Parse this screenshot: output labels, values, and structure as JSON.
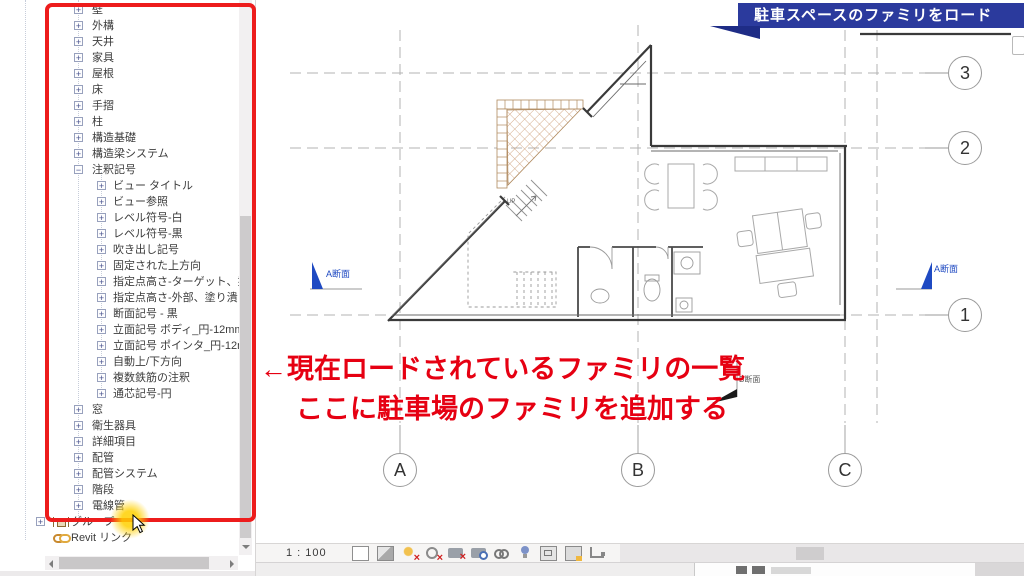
{
  "colors": {
    "highlight_red": "#ed1c1c",
    "banner_blue": "#2b3a9d",
    "annotation_red": "#e60012",
    "section_blue": "#1f4ac2"
  },
  "banner": {
    "label": "駐車スペースのファミリをロード"
  },
  "annotation": {
    "line1": "←現在ロードされているファミリの一覧",
    "line2": "ここに駐車場のファミリを追加する"
  },
  "tree": {
    "items": [
      {
        "label": "壁",
        "level": 1,
        "toggle": "plus"
      },
      {
        "label": "外構",
        "level": 1,
        "toggle": "plus"
      },
      {
        "label": "天井",
        "level": 1,
        "toggle": "plus"
      },
      {
        "label": "家具",
        "level": 1,
        "toggle": "plus"
      },
      {
        "label": "屋根",
        "level": 1,
        "toggle": "plus"
      },
      {
        "label": "床",
        "level": 1,
        "toggle": "plus"
      },
      {
        "label": "手摺",
        "level": 1,
        "toggle": "plus"
      },
      {
        "label": "柱",
        "level": 1,
        "toggle": "plus"
      },
      {
        "label": "構造基礎",
        "level": 1,
        "toggle": "plus"
      },
      {
        "label": "構造梁システム",
        "level": 1,
        "toggle": "plus"
      },
      {
        "label": "注釈記号",
        "level": 1,
        "toggle": "minus"
      },
      {
        "label": "ビュー タイトル",
        "level": 2,
        "toggle": "plus"
      },
      {
        "label": "ビュー参照",
        "level": 2,
        "toggle": "plus"
      },
      {
        "label": "レベル符号-白",
        "level": 2,
        "toggle": "plus"
      },
      {
        "label": "レベル符号-黒",
        "level": 2,
        "toggle": "plus"
      },
      {
        "label": "吹き出し記号",
        "level": 2,
        "toggle": "plus"
      },
      {
        "label": "固定された上方向",
        "level": 2,
        "toggle": "plus"
      },
      {
        "label": "指定点高さ-ターゲット、塗り潰し",
        "level": 2,
        "toggle": "plus"
      },
      {
        "label": "指定点高さ-外部、塗り潰し",
        "level": 2,
        "toggle": "plus"
      },
      {
        "label": "断面記号 - 黒",
        "level": 2,
        "toggle": "plus"
      },
      {
        "label": "立面記号 ボディ_円-12mm",
        "level": 2,
        "toggle": "plus"
      },
      {
        "label": "立面記号 ポインタ_円-12mm",
        "level": 2,
        "toggle": "plus"
      },
      {
        "label": "自動上/下方向",
        "level": 2,
        "toggle": "plus"
      },
      {
        "label": "複数鉄筋の注釈",
        "level": 2,
        "toggle": "plus"
      },
      {
        "label": "通芯記号-円",
        "level": 2,
        "toggle": "plus"
      },
      {
        "label": "窓",
        "level": 1,
        "toggle": "plus"
      },
      {
        "label": "衛生器具",
        "level": 1,
        "toggle": "plus"
      },
      {
        "label": "詳細項目",
        "level": 1,
        "toggle": "plus"
      },
      {
        "label": "配管",
        "level": 1,
        "toggle": "plus"
      },
      {
        "label": "配管システム",
        "level": 1,
        "toggle": "plus"
      },
      {
        "label": "階段",
        "level": 1,
        "toggle": "plus"
      },
      {
        "label": "電線管",
        "level": 1,
        "toggle": "plus"
      },
      {
        "label": "グループ",
        "level": 0,
        "toggle": "plus",
        "icon": "group-icon"
      },
      {
        "label": "Revit リンク",
        "level": 0,
        "toggle": "none",
        "icon": "revit-link-icon"
      }
    ]
  },
  "plan": {
    "grid_right": [
      {
        "label": "3"
      },
      {
        "label": "2"
      },
      {
        "label": "1"
      }
    ],
    "grid_bottom": [
      {
        "label": "A"
      },
      {
        "label": "B"
      },
      {
        "label": "C"
      }
    ],
    "section_left_label": "A断面",
    "section_right_label": "A断面",
    "section_bottom_label": "B断面",
    "stairs_up_label": "UP"
  },
  "view_control_bar": {
    "scale_label": "1 : 100",
    "collapse_label": "<",
    "icons": [
      {
        "name": "detail-level-icon"
      },
      {
        "name": "visual-style-icon"
      },
      {
        "name": "sun-path-icon"
      },
      {
        "name": "shadows-icon"
      },
      {
        "name": "crop-view-icon"
      },
      {
        "name": "show-crop-region-icon"
      },
      {
        "name": "temporary-hide-isolate-icon"
      },
      {
        "name": "reveal-hidden-elements-icon"
      },
      {
        "name": "temporary-view-properties-icon"
      },
      {
        "name": "hide-analytical-model-icon"
      },
      {
        "name": "reveal-constraints-icon"
      }
    ]
  }
}
